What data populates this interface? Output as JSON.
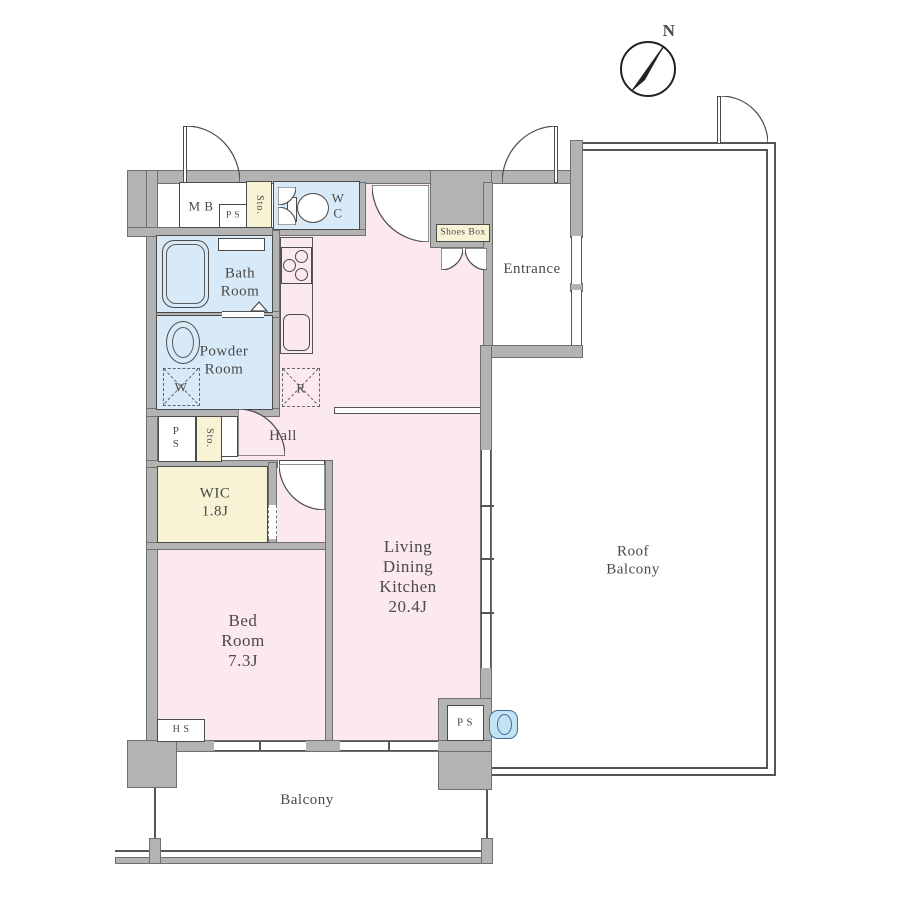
{
  "colors": {
    "wall": "#b3b3b3",
    "room_pink": "#fbe8f0",
    "room_blue": "#d8eaf7",
    "room_yellow": "#f7f3d4",
    "white": "#ffffff",
    "fixture_blue": "#c5e2f5"
  },
  "compass": {
    "north_label": "N"
  },
  "labels": {
    "mb": "M B",
    "ps_top": "P S",
    "sto_top": "Sto.",
    "wc": "W\nC",
    "shoes_box": "Shoes Box",
    "entrance": "Entrance",
    "bath": "Bath\nRoom",
    "powder": "Powder\nRoom",
    "washer": "W",
    "fridge": "R",
    "hall": "Hall",
    "ps_mid": "P\nS",
    "sto_mid": "Sto.",
    "wic": "WIC\n1.8J",
    "bedroom": "Bed\nRoom\n7.3J",
    "ldk": "Living\nDining\nKitchen\n20.4J",
    "hs": "H S",
    "ps_bottom": "P S",
    "roof_balcony": "Roof\nBalcony",
    "balcony": "Balcony"
  }
}
